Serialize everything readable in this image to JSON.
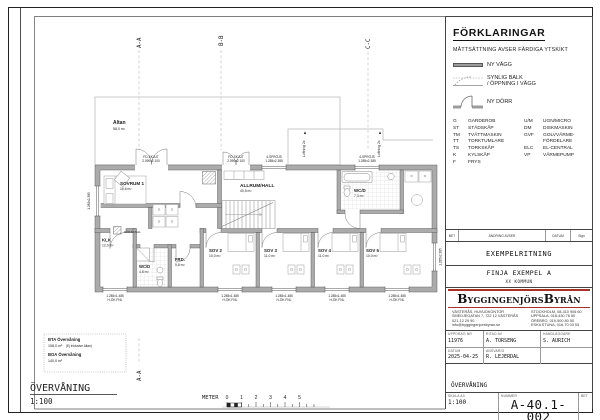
{
  "sheet": {
    "plan_title": "ÖVERVÅNING",
    "plan_scale": "1:100"
  },
  "scalebar": {
    "label": "METER",
    "ticks": [
      "0",
      "1",
      "2",
      "3",
      "4",
      "5"
    ]
  },
  "sections": {
    "aa": "A-A",
    "bb": "B-B",
    "cc": "C-C"
  },
  "areas_box": {
    "bta_label": "BTA Övervåning",
    "bta_value": "158,0 m²",
    "bta_note": "(Ej inklusive Altan)",
    "boa_label": "BOA Övervåning",
    "boa_value": "140,0 m²"
  },
  "plan": {
    "rooms": {
      "altan": {
        "name": "Altan",
        "area": "58,0 m²"
      },
      "sovrum1": {
        "name": "SOVRUM 1",
        "area": "16,6 m²"
      },
      "allrum": {
        "name": "ALLRUM/HALL",
        "area": "40,5 m²"
      },
      "wcd_top": {
        "name": "WC/D",
        "area": "7,3 m²"
      },
      "klk": {
        "name": "KLK",
        "area": "12,0 m²"
      },
      "wcd_bottom": {
        "name": "WC/D",
        "area": "4,8 m²"
      },
      "frd": {
        "name": "FRD.",
        "area": "5,8 m²"
      },
      "sov2": {
        "name": "SOV 2",
        "area": "10,0 m²"
      },
      "sov3": {
        "name": "SOV 3",
        "area": "11,0 m²"
      },
      "sov4": {
        "name": "SOV 4",
        "area": "11,0 m²"
      },
      "sov5": {
        "name": "SOV 5",
        "area": "10,0 m²"
      }
    },
    "labels": {
      "murstock": "MURSTOCK",
      "rokkanal": "RÖKKANAL",
      "luftning": "Luftning 2x"
    },
    "dims_top": [
      {
        "a": "FD-SKJUT",
        "b": "2.090x2.100"
      },
      {
        "a": "FD-SKJUT",
        "b": "2.090x2.100"
      },
      {
        "a": "4-SPRÖJS",
        "b": "1.285x2.385"
      },
      {
        "a": "4-SPRÖJS",
        "b": "1.285x2.385"
      }
    ],
    "window_dim": {
      "a": "1.285x1.485",
      "b": "H-ÖK FNL"
    },
    "side_dim": "1.285x2.385"
  },
  "legend": {
    "heading": "FÖRKLARINGAR",
    "note": "MÅTTSÄTTNING AVSER FÄRDIGA YTSKIKT",
    "wall_label": "NY VÄGG",
    "beam_label1": "SYNLIG BALK",
    "beam_label2": "/ ÖPPNING I VÄGG",
    "door_label": "NY DÖRR",
    "abbr": [
      {
        "a": "G",
        "an": "GARDEROB",
        "b": "U/M",
        "bn": "UGN/MICRO"
      },
      {
        "a": "ST",
        "an": "STÄDSKÅP",
        "b": "DM",
        "bn": "DISKMASKIN"
      },
      {
        "a": "TM",
        "an": "TVÄTTMASKIN",
        "b": "GVF",
        "bn": "GOLVVÄRME-"
      },
      {
        "a": "TT",
        "an": "TORKTUMLARE",
        "b": "",
        "bn": "FÖRDELARE"
      },
      {
        "a": "TS",
        "an": "TORKSKÅP",
        "b": "ELC",
        "bn": "EL-CENTRAL"
      },
      {
        "a": "K",
        "an": "KYLSKÅP",
        "b": "VP",
        "bn": "VÄRMEPUMP"
      },
      {
        "a": "F",
        "an": "FRYS",
        "b": "",
        "bn": ""
      }
    ]
  },
  "revision": {
    "bet": "BET",
    "andring": "ÄNDRING AVSER",
    "datum": "DATUM",
    "sign": "Sign"
  },
  "titleblock": {
    "drawing_type": "EXEMPELRITNING",
    "project": "FINJA EXEMPEL A",
    "municipality": "XX KOMMUN",
    "company": "ByggingenjörsByrån",
    "office_left": [
      "VÄSTERÅS, HUVUDKONTOR",
      "SMEDJEGATAN 7, 722 12 VÄSTERÅS",
      "021-12 29 90",
      "info@byggingenjorsbyran.se"
    ],
    "office_right": [
      "STOCKHOLM, 08-410 906 60",
      "UPPSALA, 018-430 76 50",
      "ÖREBRO, 019-500 80 50",
      "ESKILSTUNA, 016-70 03 53"
    ],
    "uppdrag_label": "UPPDRAG NR",
    "uppdrag": "11976",
    "ritad_label": "RITAD AV",
    "ritad": "A. TORSENG",
    "handl_label": "HANDLÄGGARE",
    "handl": "S. AURICH",
    "datum_label": "DATUM",
    "datum": "2025-04-25",
    "ansvarig_label": "ANSVARIG",
    "ansvarig": "R. LEJERDAL",
    "content": "ÖVERVÅNING",
    "skala_label": "SKALA A3",
    "skala": "1:100",
    "nummer_label": "NUMMER",
    "nummer": "A-40.1-002",
    "bet_label": "BET"
  },
  "colors": {
    "accent_red": "#a93226",
    "wall_gray": "#ababab",
    "tile_gray": "#d8d8d8"
  }
}
